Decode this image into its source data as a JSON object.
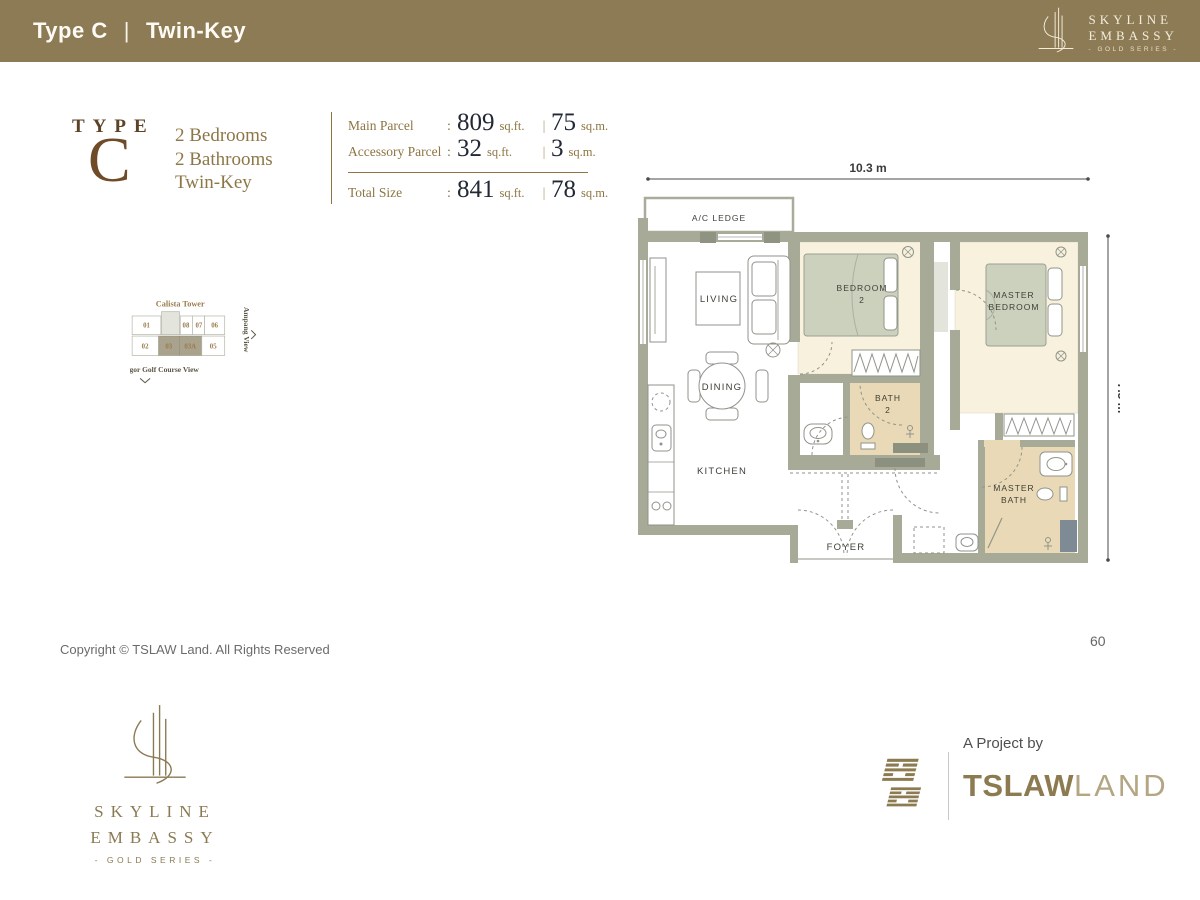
{
  "header": {
    "title_left": "Type C",
    "divider": "|",
    "title_right": "Twin-Key",
    "logo": {
      "line1": "SKYLINE",
      "line2": "EMBASSY",
      "line3": "- GOLD SERIES -"
    }
  },
  "type_block": {
    "label": "TYPE",
    "letter": "C"
  },
  "summary": {
    "line1": "2 Bedrooms",
    "line2": "2 Bathrooms",
    "line3": "Twin-Key"
  },
  "parcel_info": {
    "colon": ":",
    "bar": "|",
    "main": {
      "label": "Main Parcel",
      "sqft": "809",
      "sqft_unit": "sq.ft.",
      "sqm": "75",
      "sqm_unit": "sq.m."
    },
    "accessory": {
      "label": "Accessory Parcel",
      "sqft": "32",
      "sqft_unit": "sq.ft.",
      "sqm": "3",
      "sqm_unit": "sq.m."
    },
    "total": {
      "label": "Total Size",
      "sqft": "841",
      "sqft_unit": "sq.ft.",
      "sqm": "78",
      "sqm_unit": "sq.m."
    }
  },
  "keyplan": {
    "compass": "N",
    "views": {
      "top": "Titiwangsa View",
      "left": "Kuala Lumpur City View",
      "right": "Ampang View",
      "bottom": "Royal Selangor Golf Course View"
    },
    "highlighted_units": [
      "03",
      "03A"
    ],
    "towers": {
      "aurum": {
        "name": "Aurum Tower",
        "units": {
          "u02": "02",
          "u01": "01",
          "u03": "03",
          "u03a": "03A",
          "u05": "05",
          "u08": "08",
          "u07": "07",
          "u06": "06"
        }
      },
      "brion": {
        "name": "Brion Tower",
        "units": {
          "u05": "05",
          "u06": "06",
          "u07": "07",
          "u08": "08",
          "u03a": "03A",
          "u03": "03",
          "u02": "02",
          "u01": "01"
        }
      },
      "calista": {
        "name": "Calista Tower",
        "units": {
          "u01": "01",
          "u08": "08",
          "u07": "07",
          "u06": "06",
          "u02": "02",
          "u03": "03",
          "u03a": "03A",
          "u05": "05"
        }
      }
    }
  },
  "floorplan": {
    "dim_width": "10.3 m",
    "dim_height": "7.5 m",
    "rooms": {
      "ac_ledge": "A/C LEDGE",
      "living": "LIVING",
      "dining": "DINING",
      "kitchen": "KITCHEN",
      "foyer": "FOYER",
      "bedroom2_1": "BEDROOM",
      "bedroom2_2": "2",
      "master_1": "MASTER",
      "master_2": "BEDROOM",
      "bath2_1": "BATH",
      "bath2_2": "2",
      "mbath_1": "MASTER",
      "mbath_2": "BATH"
    }
  },
  "footer": {
    "copyright": "Copyright © TSLAW Land. All Rights Reserved",
    "page_number": "60",
    "logo": {
      "line1": "SKYLINE",
      "line2": "EMBASSY",
      "line3": "- GOLD SERIES -"
    },
    "project": {
      "label": "A Project by",
      "brand_bold": "TSLAW",
      "brand_light": "LAND"
    }
  },
  "colors": {
    "header_bg": "#8c7b55",
    "gold": "#8d7442",
    "brown": "#6f4b28",
    "number_ink": "#222835",
    "wall": "#a6aa97",
    "cream_floor": "#f8f1de",
    "tan_floor": "#ead9b6",
    "bed_sage": "#ccd1bd",
    "keyplan_highlight": "#a9a28c"
  }
}
